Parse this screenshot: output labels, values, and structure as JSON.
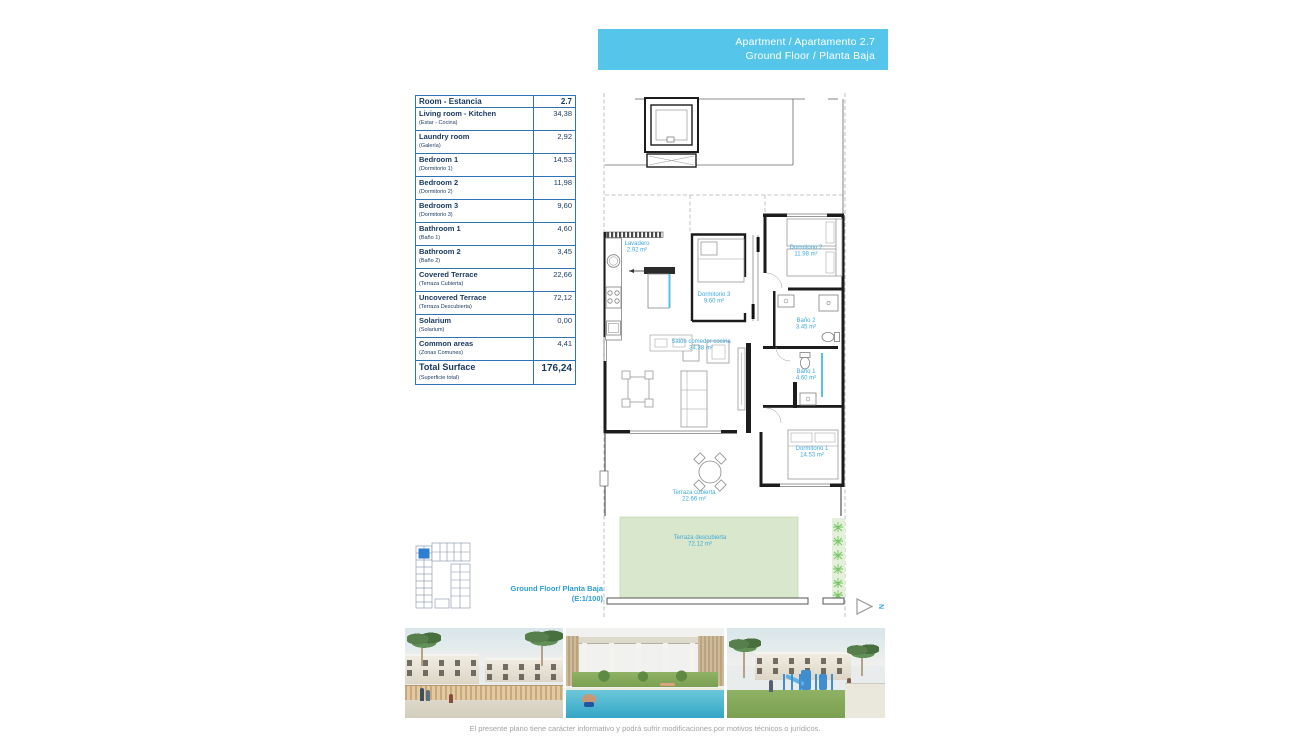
{
  "banner": {
    "line1": "Apartment / Apartamento 2.7",
    "line2": "Ground Floor / Planta Baja"
  },
  "table": {
    "header": {
      "label": "Room - Estancia",
      "value": "2.7"
    },
    "rows": [
      {
        "name": "Living room - Kitchen",
        "sub": "(Estar - Cocina)",
        "value": "34,38"
      },
      {
        "name": "Laundry room",
        "sub": "(Galería)",
        "value": "2,92"
      },
      {
        "name": "Bedroom 1",
        "sub": "(Dormitorio 1)",
        "value": "14,53"
      },
      {
        "name": "Bedroom 2",
        "sub": "(Dormitorio 2)",
        "value": "11,98"
      },
      {
        "name": "Bedroom 3",
        "sub": "(Dormitorio 3)",
        "value": "9,60"
      },
      {
        "name": "Bathroom 1",
        "sub": "(Baño 1)",
        "value": "4,60"
      },
      {
        "name": "Bathroom 2",
        "sub": "(Baño 2)",
        "value": "3,45"
      },
      {
        "name": "Covered Terrace",
        "sub": "(Terraza Cubierta)",
        "value": "22,66"
      },
      {
        "name": "Uncovered Terrace",
        "sub": "(Terraza Descubierta)",
        "value": "72,12"
      },
      {
        "name": "Solarium",
        "sub": "(Solarium)",
        "value": "0,00"
      },
      {
        "name": "Common areas",
        "sub": "(Zonas Comunes)",
        "value": "4,41"
      }
    ],
    "total": {
      "name": "Total Surface",
      "sub": "(Superficie total)",
      "value": "176,24"
    }
  },
  "plan": {
    "rooms": {
      "lavadero": {
        "name": "Lavadero",
        "area": "2.92 m²"
      },
      "dormitorio2": {
        "name": "Dormitorio 2",
        "area": "11.98 m²"
      },
      "dormitorio3": {
        "name": "Dormitorio 3",
        "area": "9.60 m²"
      },
      "bano2": {
        "name": "Baño 2",
        "area": "3.45 m²"
      },
      "salon": {
        "name": "Salón comedor cocina",
        "area": "34.38 m²"
      },
      "bano1": {
        "name": "Baño 1",
        "area": "4.60 m²"
      },
      "dormitorio1": {
        "name": "Dormitorio 1",
        "area": "14.53 m²"
      },
      "terraza_cubierta": {
        "name": "Terraza cubierta",
        "area": "22.66 m²"
      },
      "terraza_descubierta": {
        "name": "Terraza descubierta",
        "area": "72.12 m²"
      }
    },
    "north": "N"
  },
  "footer": {
    "floor_label_line1": "Ground Floor/ Planta Baja",
    "floor_label_line2": "(E:1/100)",
    "disclaimer": "El presente plano tiene carácter informativo y podrá sufrir modificaciones por motivos técnicos o jurídicos."
  },
  "colors": {
    "banner_cyan": "#55c6ea",
    "plan_label_blue": "#3fa9dc",
    "table_navy": "#17375e",
    "table_border_blue": "#2e74b5",
    "terrace_green": "#d9e8cc",
    "keyplan_highlight": "#2d7dd2"
  }
}
